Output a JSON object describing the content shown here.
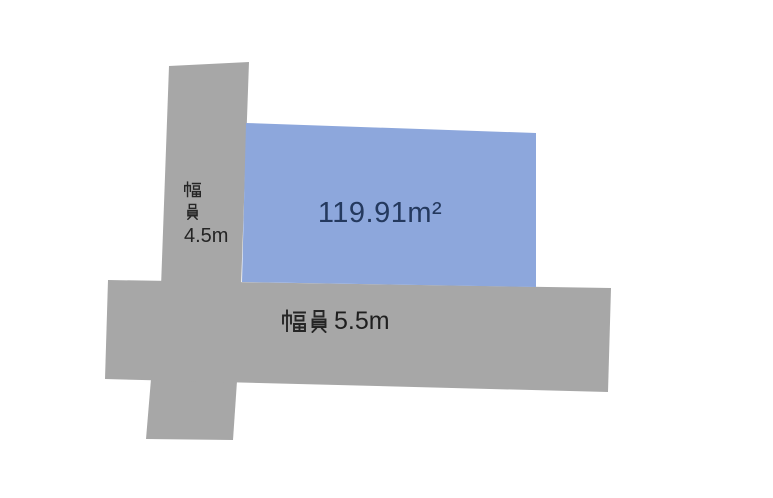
{
  "diagram": {
    "type": "land-plot-layout",
    "plot": {
      "area_label": "119.91m²"
    },
    "roads": {
      "left": {
        "label": "幅員4.5m",
        "kanji": "幅員",
        "value": "4.5m"
      },
      "bottom": {
        "label": "幅員5.5m",
        "kanji": "幅員",
        "value": "5.5m"
      }
    }
  },
  "colors": {
    "background": "#ffffff",
    "road_fill": "#a7a7a7",
    "plot_fill": "#8da7dc",
    "plot_text": "#24395e",
    "label_text": "#262626"
  }
}
